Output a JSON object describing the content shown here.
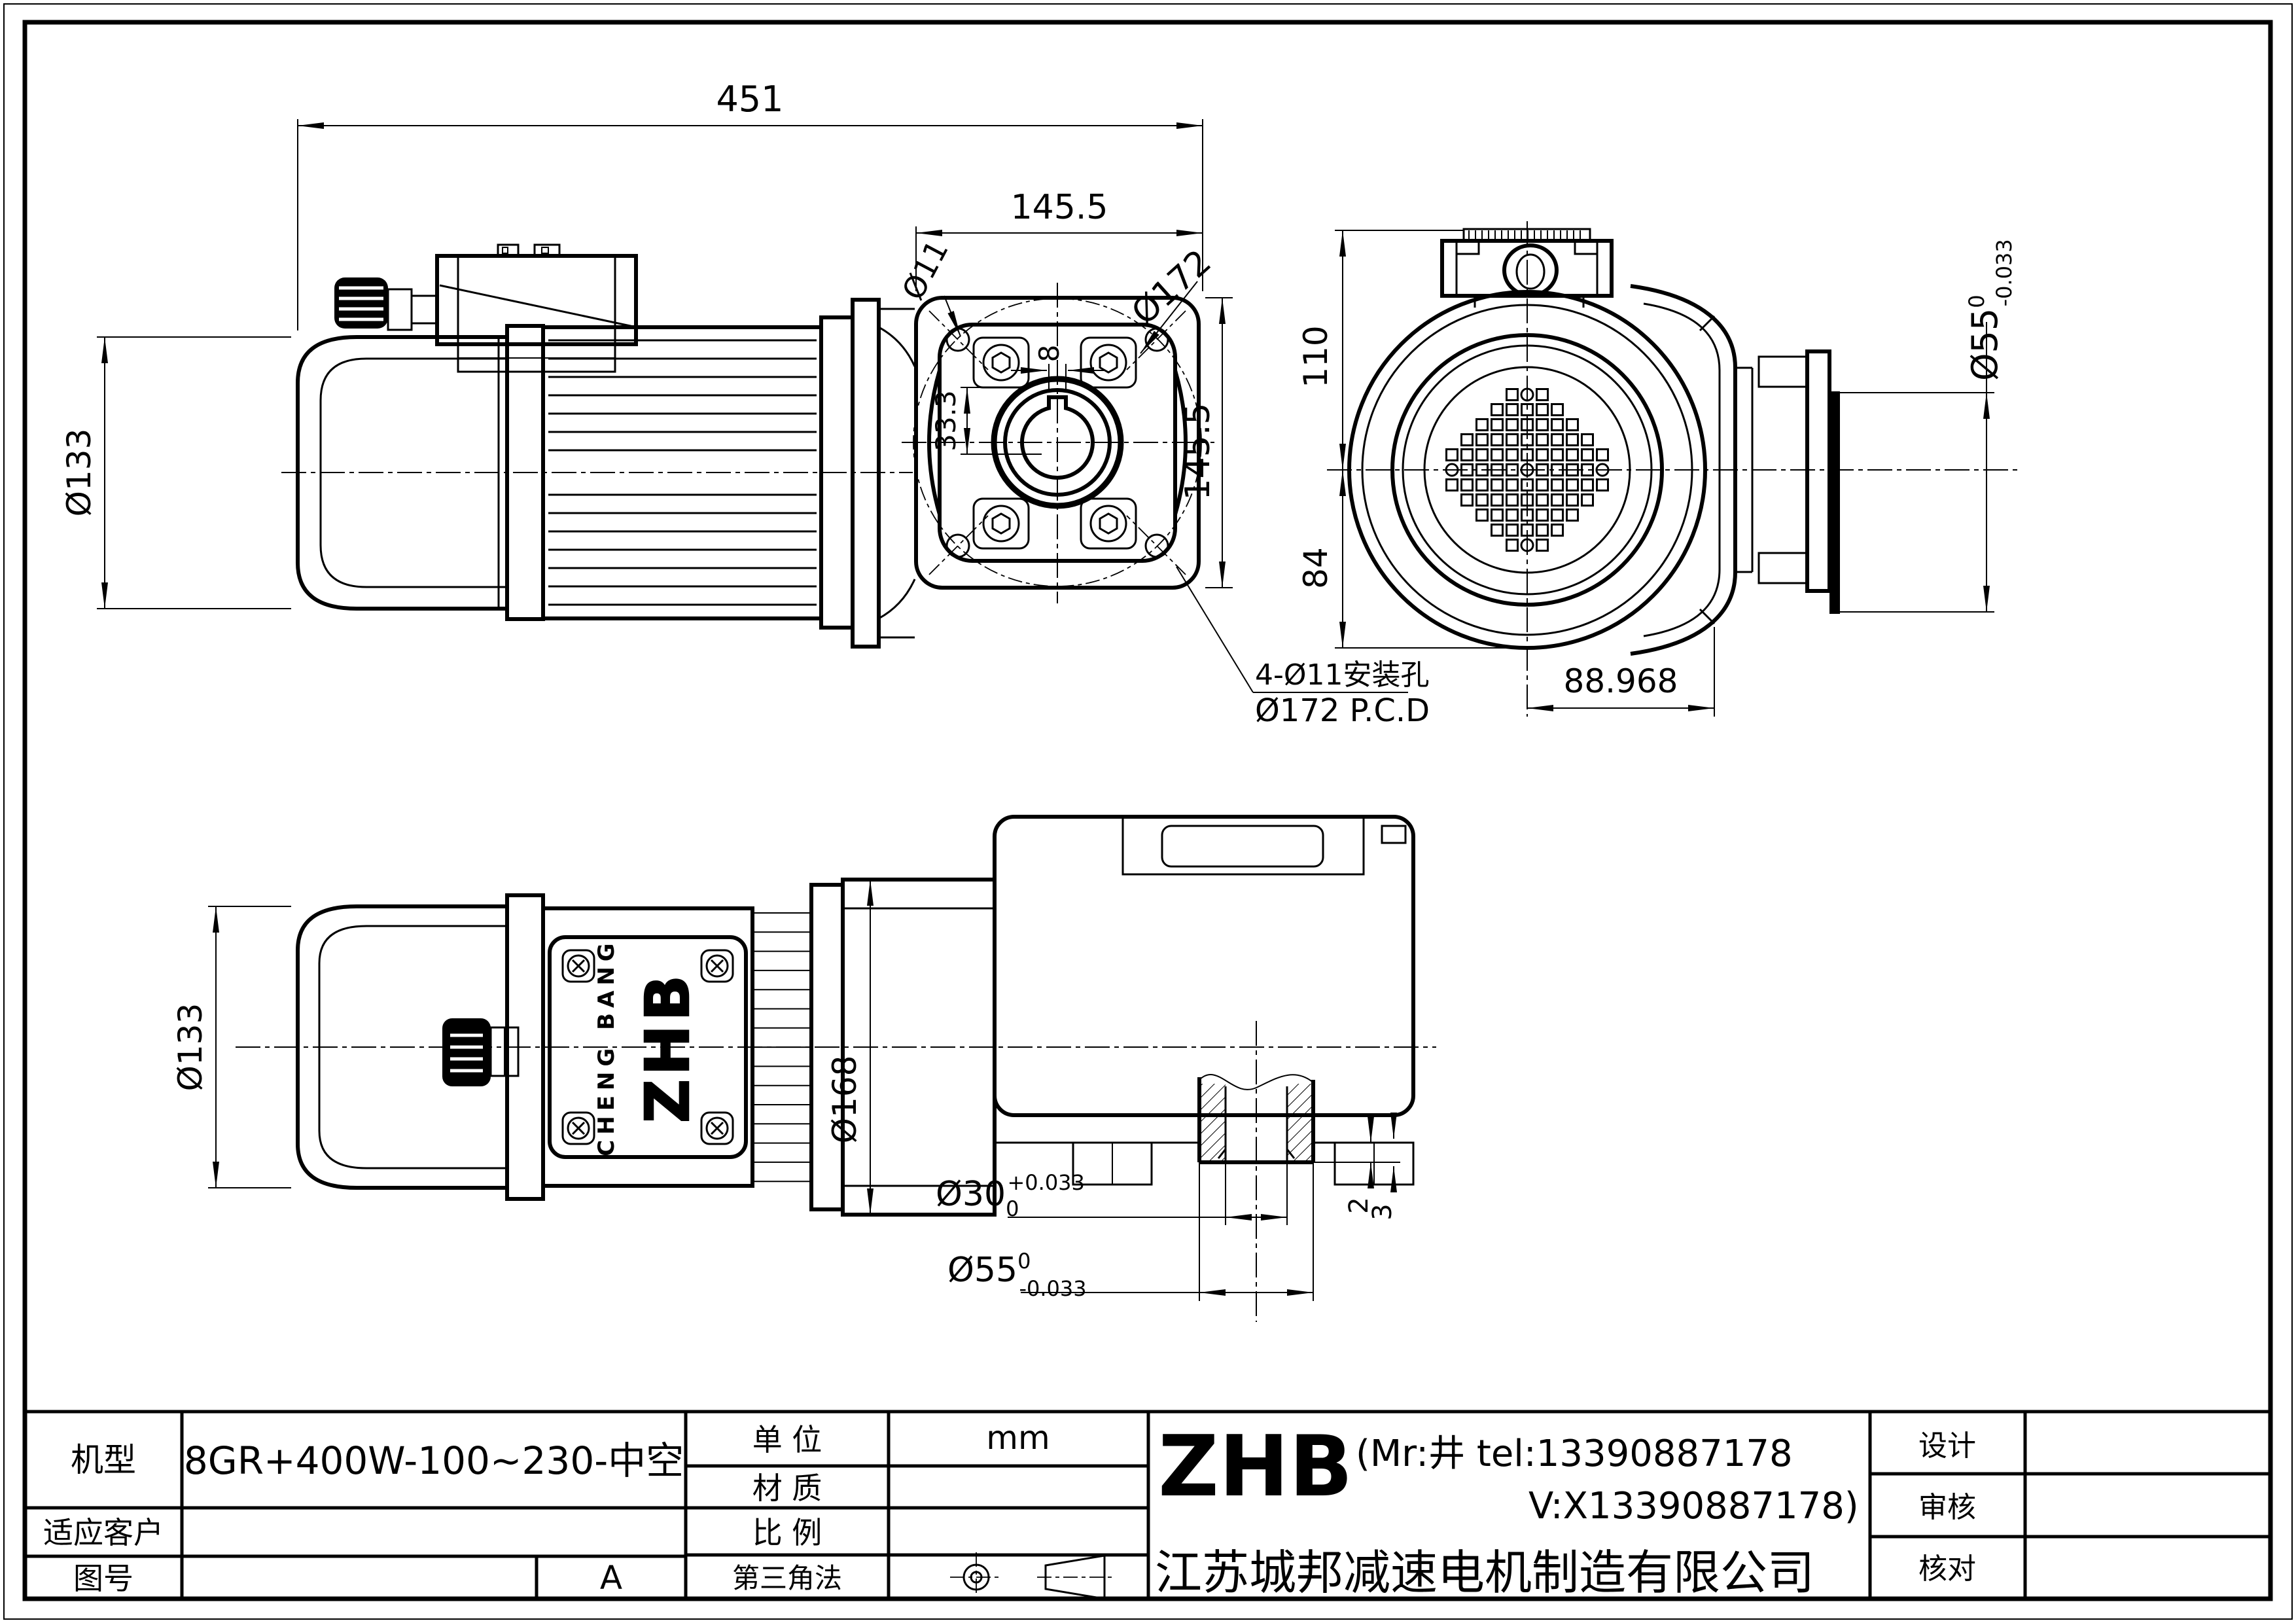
{
  "title_block": {
    "model_label": "机型",
    "model_value": "8GR+400W-100~230-中空",
    "customer_label": "适应客户",
    "drawing_no_label": "图号",
    "revision": "A",
    "unit_label": "单  位",
    "unit_value": "mm",
    "material_label": "材  质",
    "scale_label": "比  例",
    "projection_label": "第三角法",
    "brand": "ZHB",
    "contact_line1": "(Mr:井 tel:13390887178",
    "contact_line2": "V:X13390887178)",
    "company": "江苏城邦减速电机制造有限公司",
    "design_label": "设计",
    "review_label": "审核",
    "check_label": "核对"
  },
  "views": {
    "side": {
      "dim_length": "451",
      "dim_flange_width": "145.5",
      "dim_motor_dia": "Ø133",
      "dim_hole": "Ø11"
    },
    "flange": {
      "dim_key_width": "8",
      "dim_key_depth": "33.3",
      "dim_pcd": "Ø172",
      "dim_square": "145.5",
      "note_holes": "4-Ø11安装孔",
      "note_pcd": "Ø172 P.C.D"
    },
    "rear": {
      "dim_top": "110",
      "dim_bottom": "84",
      "dim_width": "88.968",
      "shaft_dia": "Ø55",
      "shaft_tol_upper": "0",
      "shaft_tol_lower": "-0.033"
    },
    "plan": {
      "dim_motor_dia": "Ø133",
      "dim_gear_dia": "Ø168",
      "plate_brand": "ZHB",
      "plate_maker": "CHENG BANG",
      "bore_dia": "Ø30",
      "bore_tol_lower": "0",
      "bore_tol_upper": "+0.033",
      "hub_dia": "Ø55",
      "hub_tol_upper": "0",
      "hub_tol_lower": "-0.033",
      "dim_step_a": "2",
      "dim_step_b": "3"
    }
  }
}
